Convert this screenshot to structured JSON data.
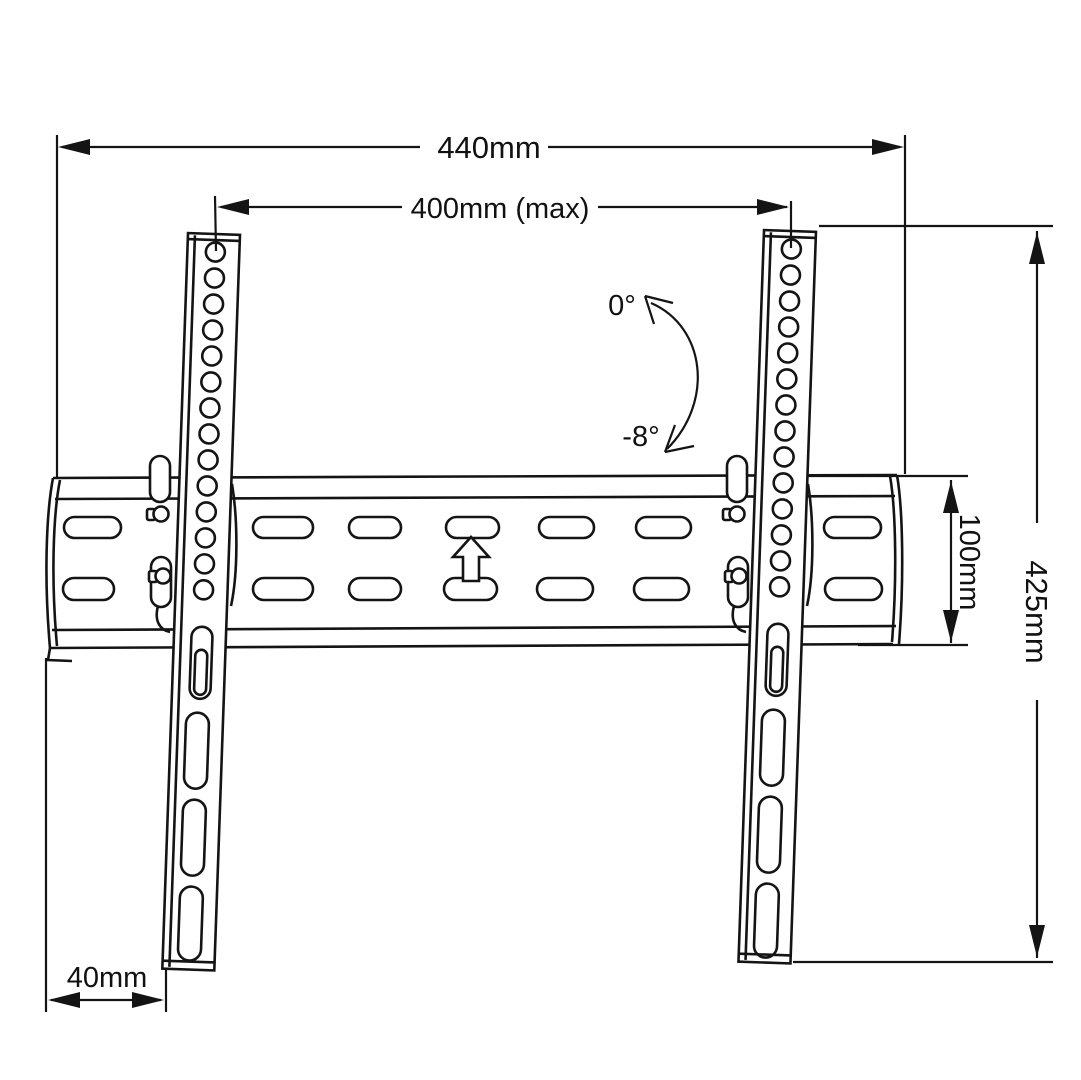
{
  "drawing": {
    "subject": "tilting-tv-wall-mount-dimension-diagram",
    "background_color": "#ffffff",
    "line_color": "#141414",
    "labels": {
      "overall_width": "440mm",
      "max_hole_spacing": "400mm (max)",
      "bracket_height": "425mm",
      "rail_height": "100mm",
      "edge_offset": "40mm",
      "tilt_upper": "0°",
      "tilt_lower": "-8°"
    }
  }
}
